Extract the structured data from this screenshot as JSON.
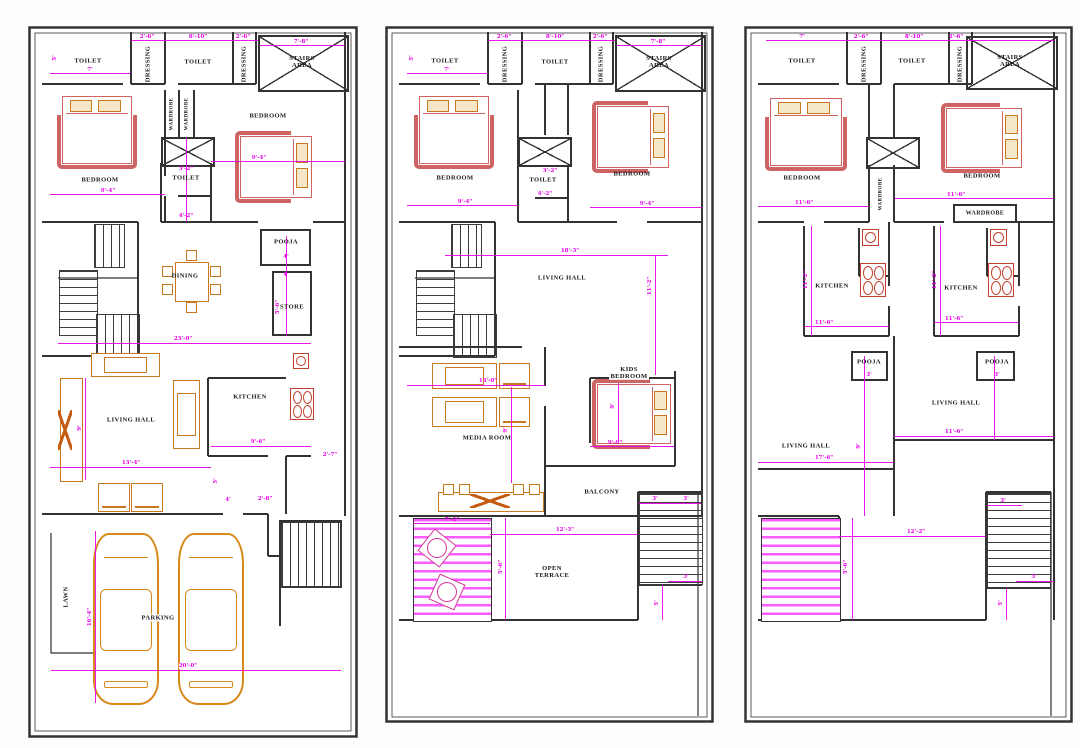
{
  "colors": {
    "wall": "#333333",
    "dimension": "#e800e8",
    "furniture_wood": "#c8781e",
    "bed_frame": "#cd6363",
    "fixture_red": "#c2402e",
    "hatch_magenta": "#ff5cff"
  },
  "plans": [
    {
      "rooms": {
        "toilet_a": "TOILET",
        "dressing_a": "DRESSING",
        "toilet_b": "TOILET",
        "dressing_b": "DRESSING",
        "stairs_area": "STAIRS AREA",
        "bedroom_a": "BEDROOM",
        "wardrobe_a": "WARDROBE",
        "wardrobe_b": "WARDROBE",
        "toilet_c": "TOILET",
        "bedroom_b": "BEDROOM",
        "pooja": "POOJA",
        "dining": "DINING",
        "store": "STORE",
        "kitchen": "KITCHEN",
        "living_hall": "LIVING HALL",
        "lawn": "LAWN",
        "parking": "PARKING"
      },
      "dims": {
        "t1": "2'-6\"",
        "t2": "8'-10\"",
        "t3": "2'-6\"",
        "t4": "7'-8\"",
        "t5": "7'",
        "t6": "5'",
        "bedA": "9'-4\"",
        "bedB": "9'-4\"",
        "tc1": "3'-2\"",
        "tc2": "4'-2\"",
        "pooja_w": "4'",
        "store_w": "4'",
        "store_h": "5'-6\"",
        "hall_w": "23'-0\"",
        "kitchen_w": "9'-6\"",
        "living_w": "13'-4\"",
        "living_h": "9'",
        "g1": "4'",
        "g2": "2'-8\"",
        "g3": "2'-7\"",
        "g4": "5'",
        "park_w": "20'-0\"",
        "park_h": "16'-4\""
      }
    },
    {
      "rooms": {
        "toilet_a": "TOILET",
        "dressing_a": "DRESSING",
        "toilet_b": "TOILET",
        "dressing_b": "DRESSING",
        "stairs_area": "STAIRS AREA",
        "bedroom_a": "BEDROOM",
        "toilet_c": "TOILET",
        "bedroom_b": "BEDROOM",
        "living_hall": "LIVING HALL",
        "media_room": "MEDIA ROOM",
        "kids_bedroom": "KIDS BEDROOM",
        "balcony": "BALCONY",
        "open_terrace": "OPEN TERRACE"
      },
      "dims": {
        "t1": "2'-6\"",
        "t2": "8'-10\"",
        "t3": "2'-6\"",
        "t4": "7'-8\"",
        "t5": "7'",
        "t6": "5'",
        "bedA": "9'-4\"",
        "bedB": "9'-4\"",
        "tc1": "3'-2\"",
        "tc2": "4'-2\"",
        "hall_w": "18'-3\"",
        "hall_h": "11'-2\"",
        "media_w": "13'-0\"",
        "media_h": "9'",
        "kids_h": "9'",
        "kids_w": "9'-0\"",
        "terr_w": "12'-3\"",
        "deck_w": "7'-2\"",
        "deck_h": "5'-6\"",
        "s1": "3'",
        "s2": "3'",
        "s3": "3'",
        "s4": "5'"
      }
    },
    {
      "rooms": {
        "toilet_a": "TOILET",
        "dressing_a": "DRESSING",
        "toilet_b": "TOILET",
        "dressing_b": "DRESSING",
        "stairs_area": "STAIRS AREA",
        "bedroom_a": "BEDROOM",
        "bedroom_b": "BEDROOM",
        "wardrobe_mid": "WARDROBE",
        "wardrobe_b": "WARDROBE",
        "kitchen_a": "KITCHEN",
        "kitchen_b": "KITCHEN",
        "pooja_a": "POOJA",
        "pooja_b": "POOJA",
        "living_a": "LIVING HALL",
        "living_b": "LIVING HALL"
      },
      "dims": {
        "t0": "7'",
        "t1": "2'-6\"",
        "t2": "8'-10\"",
        "t3": "2'-6\"",
        "bedA": "11'-6\"",
        "bedB": "11'-6\"",
        "kitA": "11'-6\"",
        "kitB": "11'-6\"",
        "kitAh": "11'-2\"",
        "kitBh": "11'-2\"",
        "poojaA": "3'",
        "poojaB": "3'",
        "livA": "17'-6\"",
        "livB": "11'-6\"",
        "livAh": "9'",
        "terr_w": "12'-2\"",
        "deck_h": "5'-6\"",
        "s1": "3'",
        "s2": "3'",
        "s3": "5'",
        "s4": "3'"
      }
    }
  ]
}
